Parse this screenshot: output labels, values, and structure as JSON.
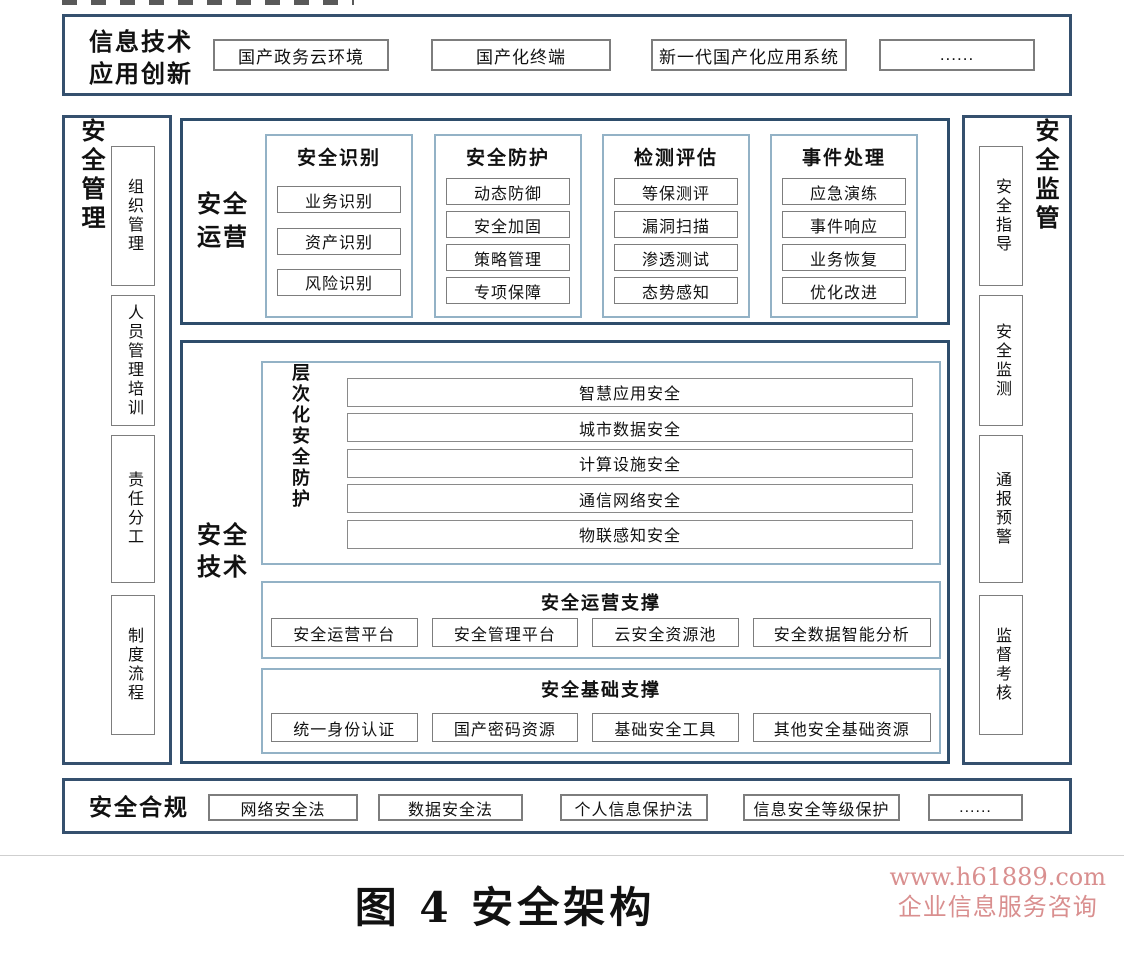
{
  "top_band": {
    "label": "信息技术\n应用创新",
    "items": [
      "国产政务云环境",
      "国产化终端",
      "新一代国产化应用系统",
      "......"
    ]
  },
  "left_band": {
    "label": "安全管理",
    "items": [
      "组织管理",
      "人员管理培训",
      "责任分工",
      "制度流程"
    ]
  },
  "right_band": {
    "label": "安全监管",
    "items": [
      "安全指导",
      "安全监测",
      "通报预警",
      "监督考核"
    ]
  },
  "operations_panel": {
    "label": "安全\n运营",
    "columns": [
      {
        "header": "安全识别",
        "items": [
          "业务识别",
          "资产识别",
          "风险识别"
        ]
      },
      {
        "header": "安全防护",
        "items": [
          "动态防御",
          "安全加固",
          "策略管理",
          "专项保障"
        ]
      },
      {
        "header": "检测评估",
        "items": [
          "等保测评",
          "漏洞扫描",
          "渗透测试",
          "态势感知"
        ]
      },
      {
        "header": "事件处理",
        "items": [
          "应急演练",
          "事件响应",
          "业务恢复",
          "优化改进"
        ]
      }
    ]
  },
  "technology_panel": {
    "label": "安全\n技术",
    "layered_protection": {
      "label": "层次化安全防护",
      "layers": [
        "智慧应用安全",
        "城市数据安全",
        "计算设施安全",
        "通信网络安全",
        "物联感知安全"
      ]
    },
    "operation_support": {
      "header": "安全运营支撑",
      "items": [
        "安全运营平台",
        "安全管理平台",
        "云安全资源池",
        "安全数据智能分析"
      ]
    },
    "foundation_support": {
      "header": "安全基础支撑",
      "items": [
        "统一身份认证",
        "国产密码资源",
        "基础安全工具",
        "其他安全基础资源"
      ]
    }
  },
  "bottom_band": {
    "label": "安全合规",
    "items": [
      "网络安全法",
      "数据安全法",
      "个人信息保护法",
      "信息安全等级保护",
      "......"
    ]
  },
  "caption": "图 4 安全架构",
  "watermark": {
    "line1": "www.h61889.com",
    "line2": "企业信息服务咨询",
    "color": "#d98f8f"
  },
  "colors": {
    "outer_border": "#35506e",
    "panel_border": "#2e4d6b",
    "container_border": "#93b2c6",
    "item_border": "#7d7d7d",
    "text": "#111111"
  }
}
